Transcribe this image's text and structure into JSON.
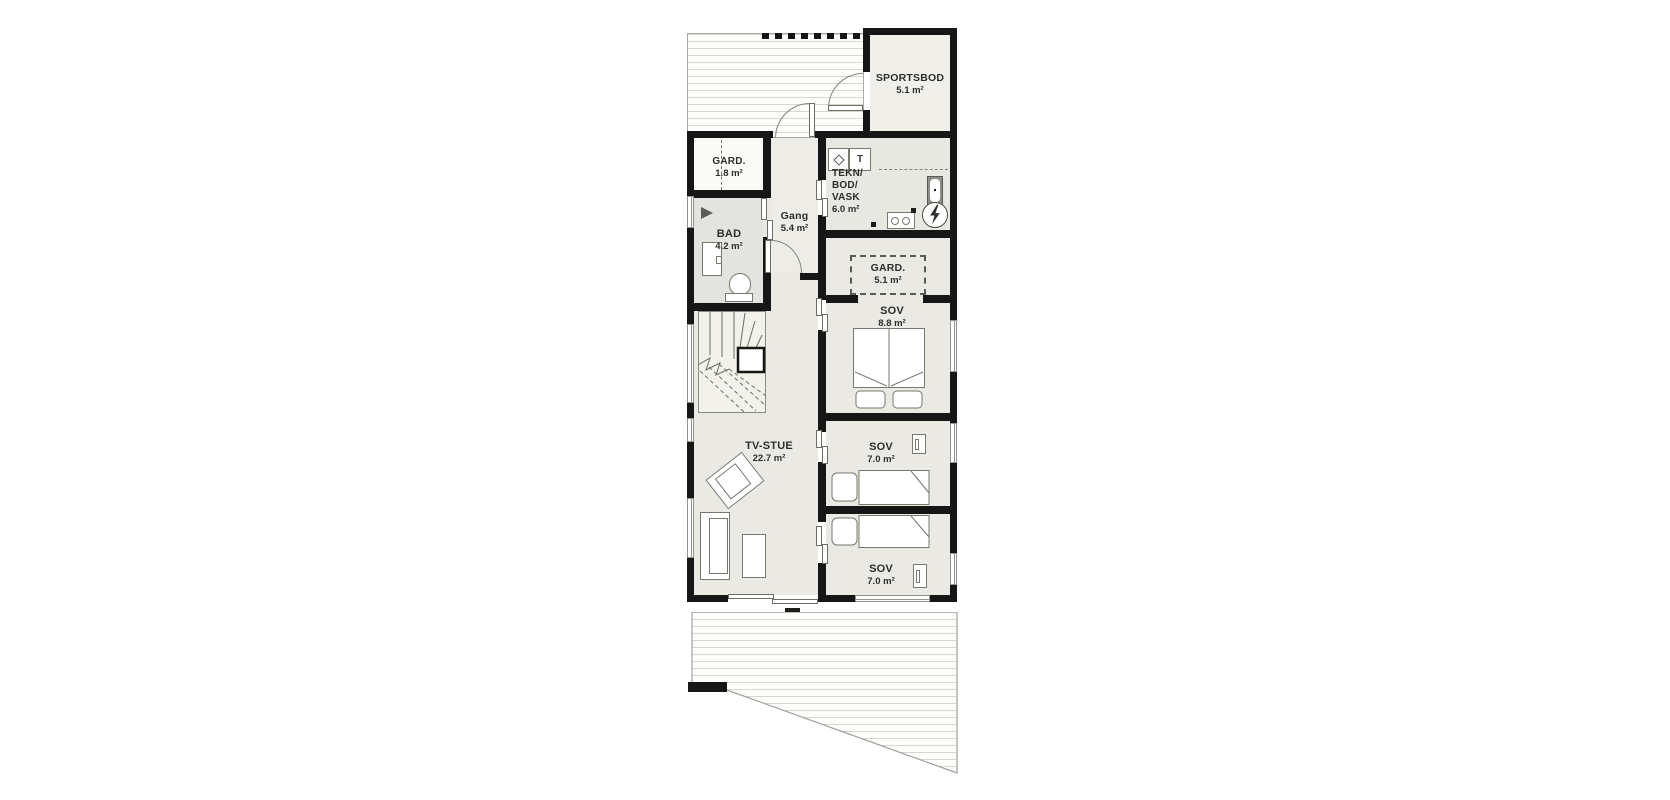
{
  "floorplan": {
    "rooms": {
      "sportsbod": {
        "name": "SPORTSBOD",
        "area": "5.1 m²"
      },
      "gard_entry": {
        "name": "GARD.",
        "area": "1.8 m²"
      },
      "gang": {
        "name": "Gang",
        "area": "5.4 m²"
      },
      "tekn": {
        "lines": [
          "TEKN/",
          "BOD/",
          "VASK"
        ],
        "area": "6.0 m²"
      },
      "bad": {
        "name": "BAD",
        "area": "4.2 m²"
      },
      "gard_sov": {
        "name": "GARD.",
        "area": "5.1 m²"
      },
      "sov_double": {
        "name": "SOV",
        "area": "8.8 m²"
      },
      "tv_stue": {
        "name": "TV-STUE",
        "area": "22.7 m²"
      },
      "sov_single_1": {
        "name": "SOV",
        "area": "7.0 m²"
      },
      "sov_single_2": {
        "name": "SOV",
        "area": "7.0 m²"
      }
    },
    "symbols": {
      "dryer_label": "T"
    },
    "colors": {
      "wall": "#161616",
      "room": "#eae9e4",
      "bathroom": "#e3e3df",
      "tech_room": "#e8e8e3",
      "storage": "#f0efe9",
      "deck_line": "#d7d7d2"
    }
  }
}
